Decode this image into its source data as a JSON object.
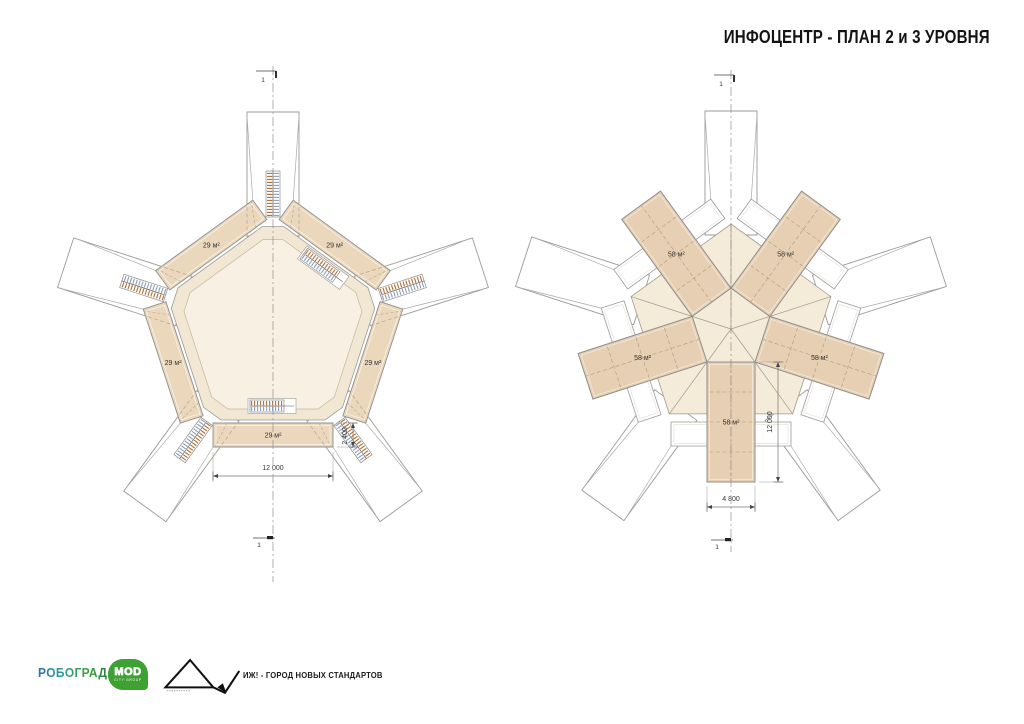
{
  "title": "ИНФОЦЕНТР - ПЛАН 2 и 3 УРОВНЯ",
  "plans": {
    "left": {
      "name": "план 2 уровня",
      "room_label": "29 м²",
      "room_count": 5,
      "dim_width": "12 000",
      "dim_depth": "2 400",
      "section_mark": "1"
    },
    "right": {
      "name": "план 3 уровня",
      "room_label": "58 м²",
      "room_count": 5,
      "dim_width": "4 800",
      "dim_length": "12 000",
      "section_mark": "1"
    }
  },
  "footer": {
    "robogard": "РОБОГРАД",
    "mod_text": "MOD",
    "mod_subtext": "CITY GROUP",
    "tagline": "ИЖ! - ГОРОД НОВЫХ СТАНДАРТОВ"
  },
  "colors": {
    "line": "#9a9a9a",
    "wall": "#8f8f8f",
    "dash": "#b7a98e",
    "room_fill": "#ead7bc",
    "rect_fill": "#e6cfb2",
    "cream": "#f2e7d3",
    "cream_inner": "#f8f1e3",
    "penta": "#f4ebd9",
    "inner_stroke": "#c3b79f",
    "stair_a": "#b26d30",
    "stair_b": "#8d9cb8",
    "mod_green": "#3da231",
    "robogard_blue": "#2f6fb3",
    "robogard_green": "#3ba437"
  }
}
